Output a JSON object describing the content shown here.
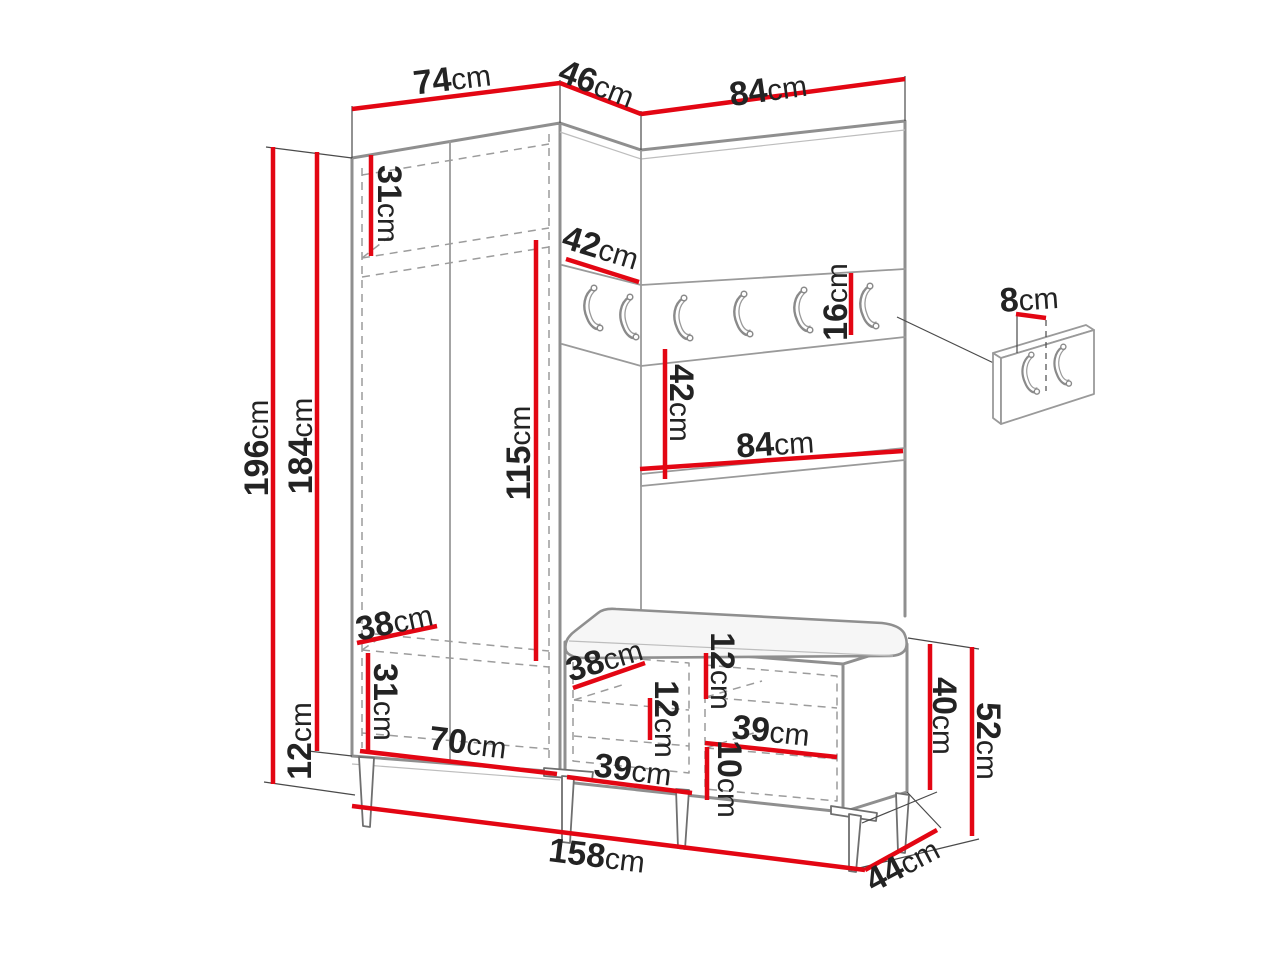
{
  "diagram": {
    "type": "furniture-dimension-drawing",
    "subject": "hallway set: corner wardrobe, coat-hook panel and shoe bench",
    "unit": "cm",
    "colors": {
      "dimension_line": "#e30613",
      "outline": "#8f8f8f",
      "text": "#232323",
      "background": "#ffffff"
    },
    "hooks": {
      "main_rail_count": 6,
      "side_panel_count": 2
    }
  },
  "dimensions": {
    "top_width_wardrobe": {
      "num": "74",
      "unit": "cm"
    },
    "top_width_corner": {
      "num": "46",
      "unit": "cm"
    },
    "top_width_panel": {
      "num": "84",
      "unit": "cm"
    },
    "total_height": {
      "num": "196",
      "unit": "cm"
    },
    "body_height": {
      "num": "184",
      "unit": "cm"
    },
    "leg_height": {
      "num": "12",
      "unit": "cm"
    },
    "top_shelf_height": {
      "num": "31",
      "unit": "cm"
    },
    "corner_rail_width": {
      "num": "42",
      "unit": "cm"
    },
    "hanging_height": {
      "num": "115",
      "unit": "cm"
    },
    "rail_height": {
      "num": "16",
      "unit": "cm"
    },
    "hook_offset": {
      "num": "8",
      "unit": "cm"
    },
    "shelf_section_height": {
      "num": "42",
      "unit": "cm"
    },
    "panel_width": {
      "num": "84",
      "unit": "cm"
    },
    "wardrobe_shelf_depth": {
      "num": "38",
      "unit": "cm"
    },
    "bottom_shelf_height": {
      "num": "31",
      "unit": "cm"
    },
    "wardrobe_inner_width": {
      "num": "70",
      "unit": "cm"
    },
    "bench_door_width": {
      "num": "38",
      "unit": "cm"
    },
    "bench_left_gap": {
      "num": "12",
      "unit": "cm"
    },
    "bench_right_gap": {
      "num": "12",
      "unit": "cm"
    },
    "bench_left_width": {
      "num": "39",
      "unit": "cm"
    },
    "bench_right_width": {
      "num": "39",
      "unit": "cm"
    },
    "bench_bottom_gap": {
      "num": "10",
      "unit": "cm"
    },
    "bench_inner_height": {
      "num": "40",
      "unit": "cm"
    },
    "bench_height": {
      "num": "52",
      "unit": "cm"
    },
    "total_width": {
      "num": "158",
      "unit": "cm"
    },
    "bench_depth": {
      "num": "44",
      "unit": "cm"
    }
  }
}
